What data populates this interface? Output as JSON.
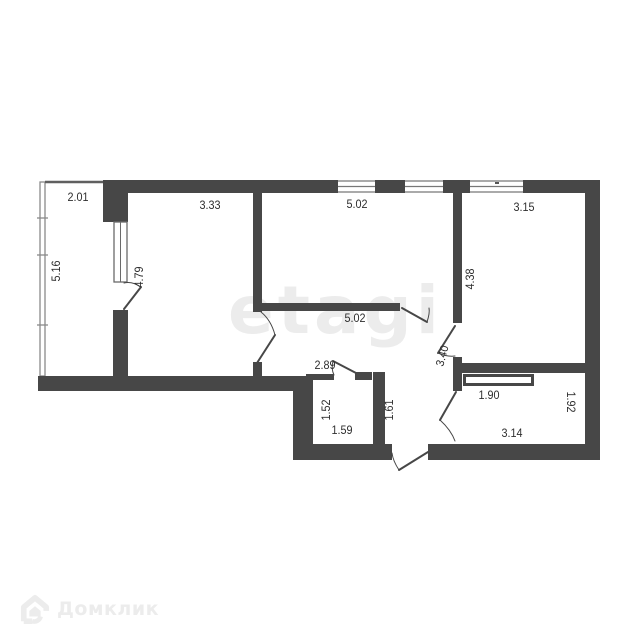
{
  "watermarks": {
    "brand_center": "etagi",
    "brand_corner": "Домклик"
  },
  "plan": {
    "colors": {
      "wall": "#474747",
      "thin_line": "#8a8a8a",
      "label": "#2e2e2e",
      "watermark": "#ececec"
    },
    "labels": [
      {
        "text": "2.01"
      },
      {
        "text": "5.16"
      },
      {
        "text": "3.33"
      },
      {
        "text": "4.79"
      },
      {
        "text": "5.02"
      },
      {
        "text": "3.15"
      },
      {
        "text": "4.38"
      },
      {
        "text": "5.02"
      },
      {
        "text": "3.40"
      },
      {
        "text": "2.89"
      },
      {
        "text": "1.52"
      },
      {
        "text": "1.59"
      },
      {
        "text": "1.61"
      },
      {
        "text": "1.90"
      },
      {
        "text": "1.92"
      },
      {
        "text": "3.14"
      }
    ]
  }
}
